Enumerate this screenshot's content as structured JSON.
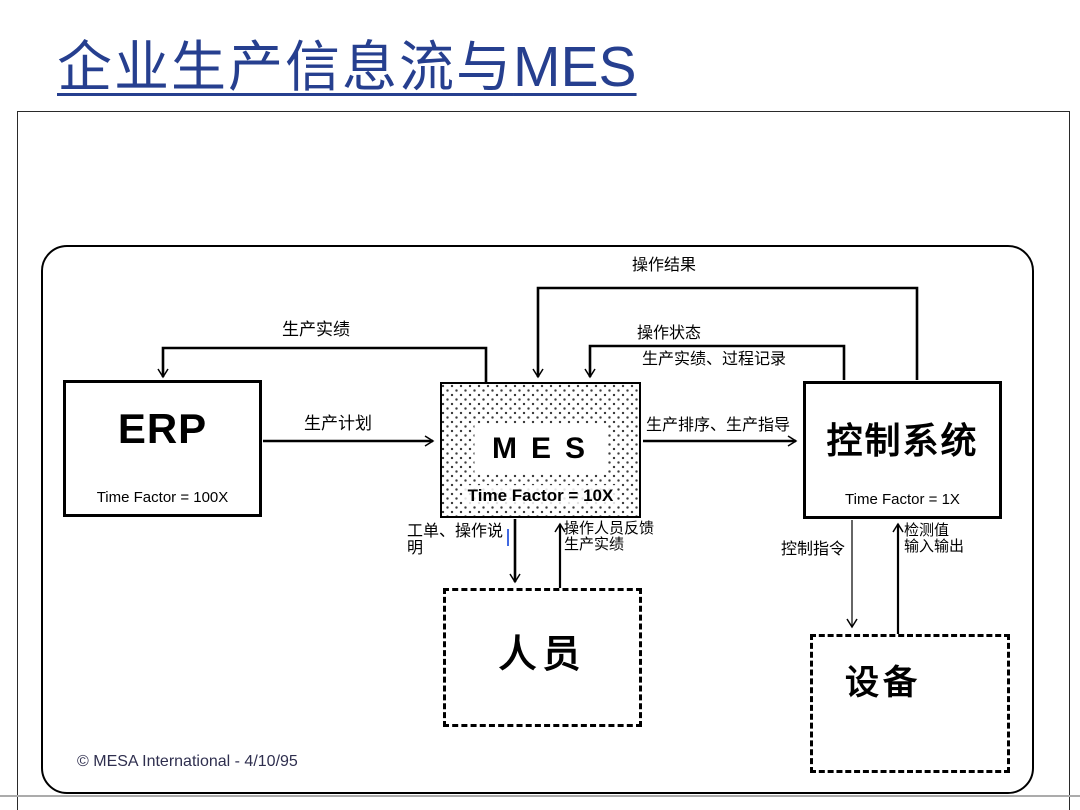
{
  "slide": {
    "title_zh": "企业生产信息流与",
    "title_en": "MES",
    "copyright": "© MESA International - 4/10/95"
  },
  "nodes": {
    "erp": {
      "name": "ERP",
      "time_factor": "Time Factor = 100X"
    },
    "mes": {
      "name": "MES",
      "time_factor": "Time Factor = 10X"
    },
    "control_system": {
      "name": "控制系统",
      "time_factor": "Time Factor = 1X"
    },
    "personnel": {
      "name": "人员"
    },
    "equipment": {
      "name": "设备"
    }
  },
  "edge_labels": {
    "production_results_top": "生产实绩",
    "operation_results": "操作结果",
    "operation_status": "操作状态",
    "production_results_process_records": "生产实绩、过程记录",
    "production_plan": "生产计划",
    "production_sequencing_guidance": "生产排序、生产指导",
    "work_order_instructions": "工单、操作说明",
    "operator_feedback_line1": "操作人员反馈",
    "operator_feedback_line2": "生产实绩",
    "control_commands": "控制指令",
    "measured_values_line1": "检测值",
    "measured_values_line2": "输入输出"
  },
  "colors": {
    "title": "#263F8F",
    "line": "#000000",
    "cursor": "#4169E1"
  }
}
